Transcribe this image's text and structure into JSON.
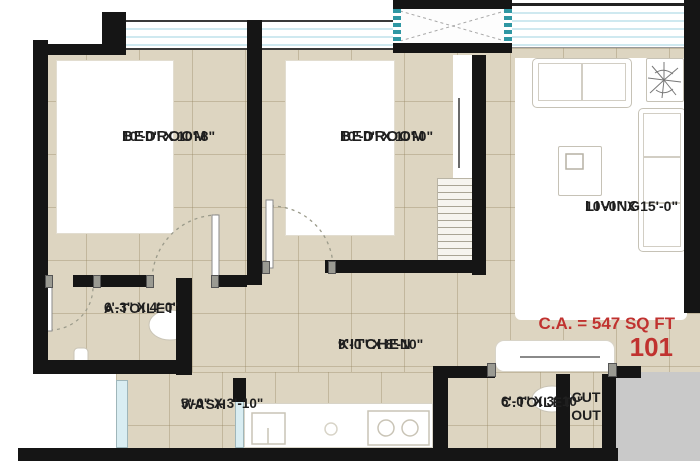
{
  "plan": {
    "rooms": {
      "bedroom1": {
        "name": "BEDROOM",
        "dims": "10'-0\" X 10'-8\""
      },
      "bedroom2": {
        "name": "BEDROOM",
        "dims": "10'-0\" X 10'-0\""
      },
      "living": {
        "name": "LIVING",
        "dims": "10'-0\" X 15'-0\""
      },
      "a_toilet": {
        "name": "A.TOILET",
        "dims": "6'-3\" X 4'-0\""
      },
      "kitchen": {
        "name": "KITCHEN",
        "dims": "9'-0\" X 8'-10\""
      },
      "wash": {
        "name": "WASH",
        "dims": "5'-0\" X 3'-10\""
      },
      "c_toilet": {
        "name": "C.TOILET",
        "dims": "6'-0\" X 3'-10\""
      },
      "cut_out": {
        "line1": "CUT",
        "line2": "OUT"
      }
    },
    "annotations": {
      "carpet_area": "C.A. = 547 SQ FT",
      "unit_number": "101"
    },
    "colors": {
      "floor_beige": "#ddd5c1",
      "wall_black": "#151515",
      "accent_red": "#c0322f",
      "window_teal": "#2f97a3",
      "outside_gray": "#c9c9c9"
    }
  }
}
